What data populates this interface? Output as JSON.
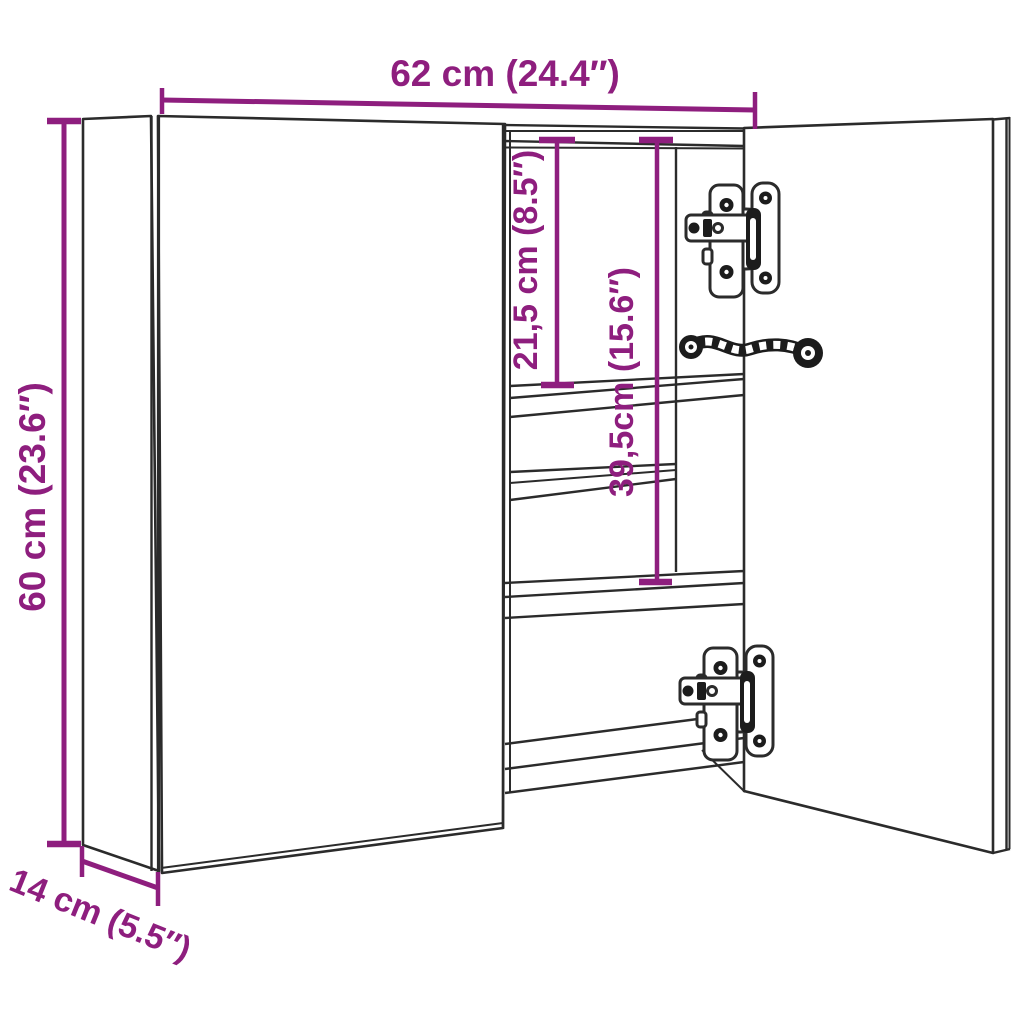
{
  "colors": {
    "accent": "#8E1E7E",
    "line": "#2B2B2B",
    "background": "#FFFFFF"
  },
  "diagram": {
    "type": "furniture-dimension-diagram",
    "subject": "Bathroom mirror cabinet line drawing with open right door, interior shelves, two cup hinges and flexible power cable",
    "dimensions": {
      "width": {
        "label": "62 cm (24.4″)",
        "cm": 62,
        "inches": 24.4
      },
      "height": {
        "label": "60 cm (23.6″)",
        "cm": 60,
        "inches": 23.6
      },
      "depth": {
        "label": "14 cm (5.5″)",
        "cm": 14,
        "inches": 5.5
      },
      "upper_compartment": {
        "label": "21,5 cm (8.5″)",
        "cm": 21.5,
        "inches": 8.5
      },
      "middle_compartment": {
        "label": "39,5cm (15.6″)",
        "cm": 39.5,
        "inches": 15.6
      }
    }
  }
}
